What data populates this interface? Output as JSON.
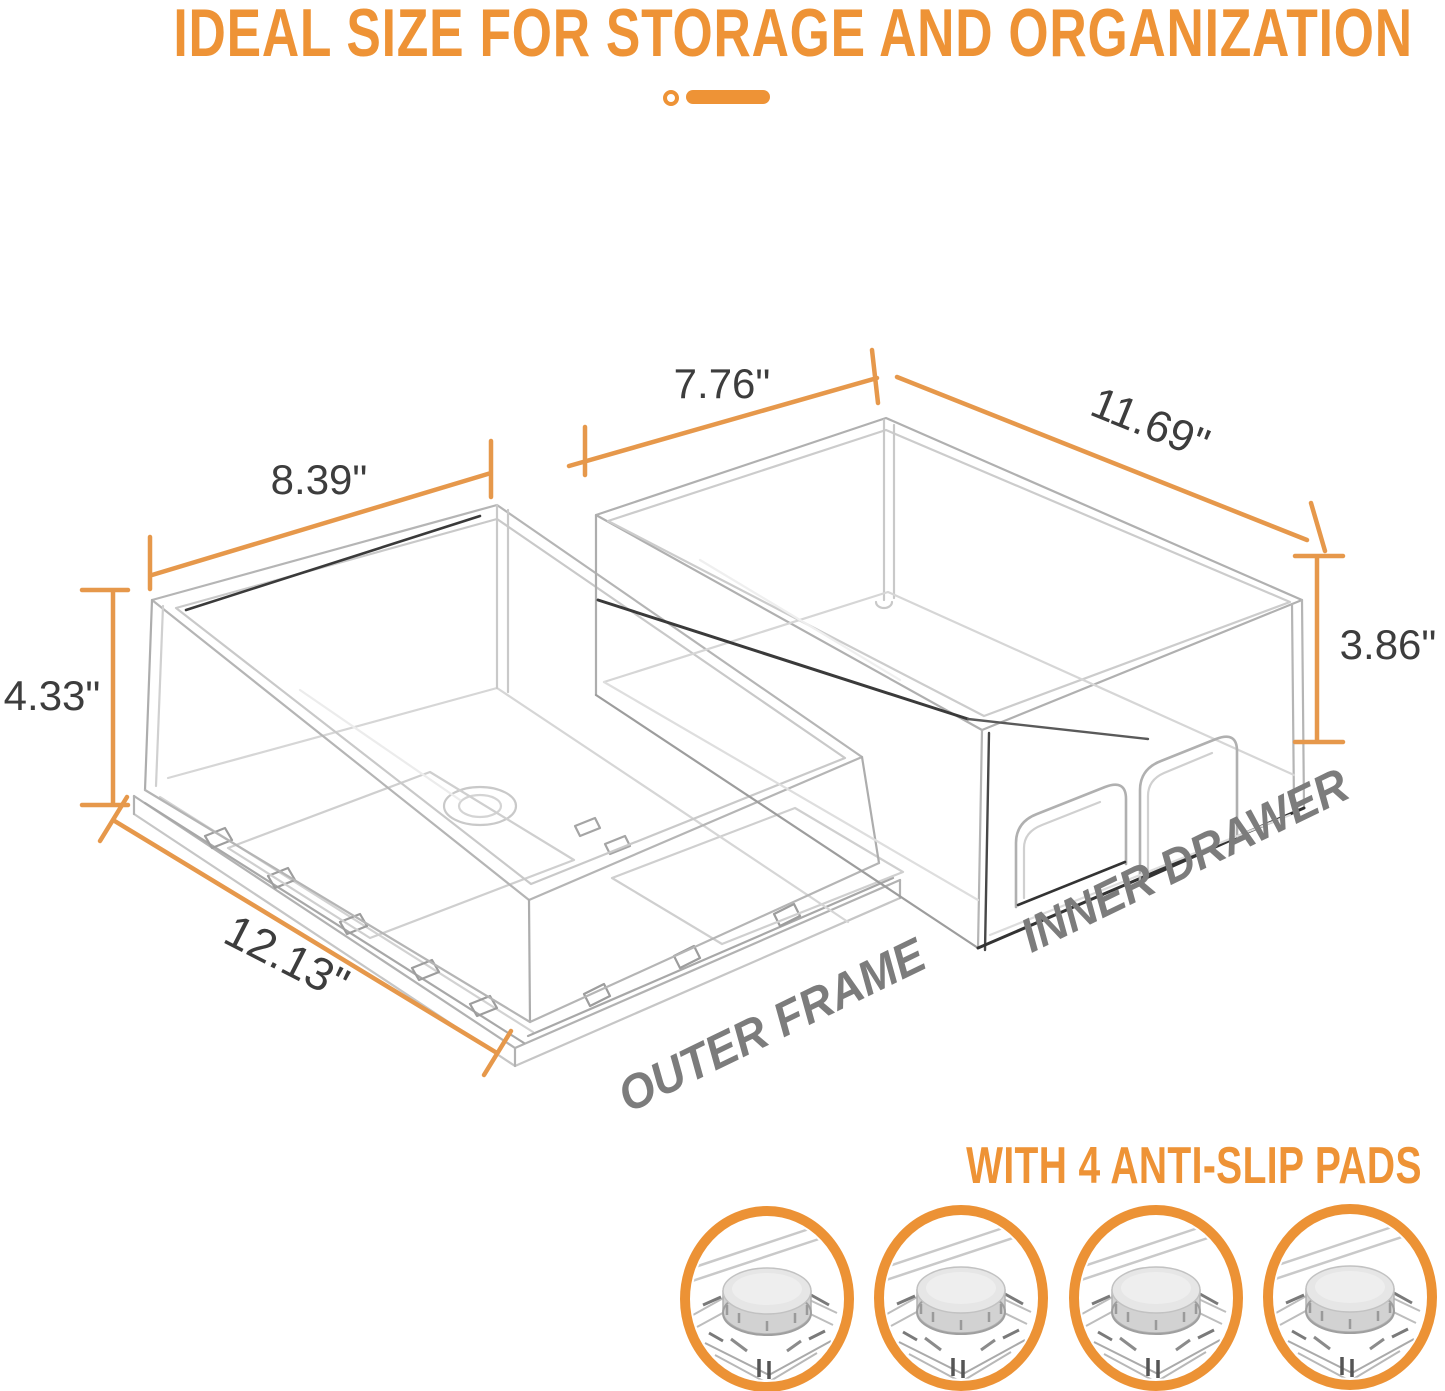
{
  "title": "IDEAL SIZE FOR STORAGE AND ORGANIZATION",
  "colors": {
    "accent_orange": "#EE9336",
    "dimension_line_orange": "#E6984B",
    "pad_ring_orange": "#EC9235",
    "label_gray": "#7C7C7C",
    "dimension_text_gray": "#3D3D3D"
  },
  "products": {
    "outer_frame": {
      "label": "OUTER FRAME",
      "width": "8.39\"",
      "height": "4.33\"",
      "depth": "12.13\""
    },
    "inner_drawer": {
      "label": "INNER DRAWER",
      "width": "7.76\"",
      "height": "3.86\"",
      "depth": "11.69\""
    }
  },
  "pads": {
    "heading": "WITH 4 ANTI-SLIP PADS",
    "count": 4
  }
}
